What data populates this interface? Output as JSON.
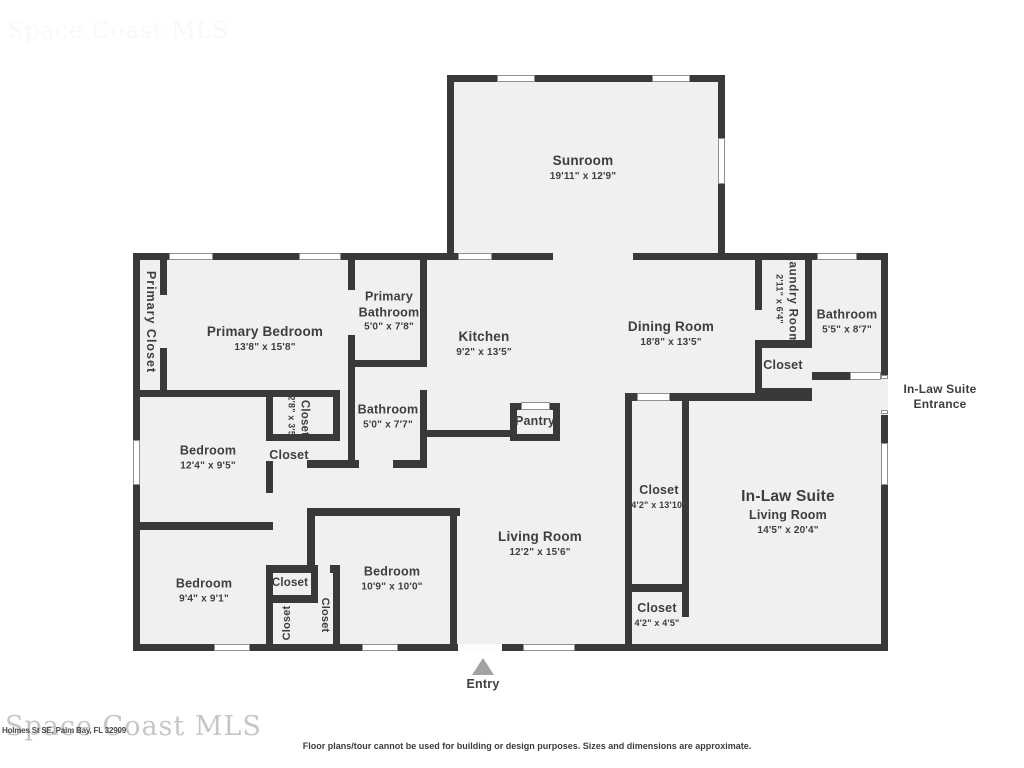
{
  "watermark": {
    "text": "Space Coast MLS"
  },
  "address": "Holmes St SE, Palm Bay, FL 32909",
  "disclaimer": "Floor plans/tour cannot be used for building or design purposes. Sizes and dimensions are approximate.",
  "entry": {
    "label": "Entry"
  },
  "colors": {
    "wall": "#39393b",
    "room_fill": "#f0f0f1",
    "label": "#3e3e41"
  },
  "rooms": {
    "sunroom": {
      "name": "Sunroom",
      "dims": "19'11\" x 12'9\""
    },
    "primary_closet": {
      "name": "Primary Closet"
    },
    "primary_bedroom": {
      "name": "Primary Bedroom",
      "dims": "13'8\" x 15'8\""
    },
    "primary_bathroom": {
      "name": "Primary Bathroom",
      "dims": "5'0\" x 7'8\""
    },
    "kitchen": {
      "name": "Kitchen",
      "dims": "9'2\" x 13'5\""
    },
    "dining_room": {
      "name": "Dining Room",
      "dims": "18'8\" x 13'5\""
    },
    "laundry_room": {
      "name": "Laundry Room",
      "dims": "2'11\" x 6'4\""
    },
    "bathroom_right": {
      "name": "Bathroom",
      "dims": "5'5\" x 8'7\""
    },
    "closet_laundry": {
      "name": "Closet"
    },
    "inlaw_entrance": {
      "name": "In-Law Suite Entrance"
    },
    "closet_28": {
      "name": "Closet",
      "dims": "2'8\" x 3'5\""
    },
    "closet_mid": {
      "name": "Closet"
    },
    "bathroom_mid": {
      "name": "Bathroom",
      "dims": "5'0\" x 7'7\""
    },
    "pantry": {
      "name": "Pantry"
    },
    "bedroom_124": {
      "name": "Bedroom",
      "dims": "12'4\" x 9'5\""
    },
    "closet_tall": {
      "name": "Closet",
      "dims": "4'2\" x 13'10\""
    },
    "inlaw_living": {
      "line1": "In-Law Suite",
      "line2": "Living Room",
      "dims": "14'5\" x 20'4\""
    },
    "living_room": {
      "name": "Living Room",
      "dims": "12'2\" x 15'6\""
    },
    "bedroom_109": {
      "name": "Bedroom",
      "dims": "10'9\" x 10'0\""
    },
    "bedroom_94": {
      "name": "Bedroom",
      "dims": "9'4\" x 9'1\""
    },
    "closet_h": {
      "name": "Closet"
    },
    "closet_v1": {
      "name": "Closet"
    },
    "closet_v2": {
      "name": "Closet"
    },
    "closet_42": {
      "name": "Closet",
      "dims": "4'2\" x 4'5\""
    }
  }
}
